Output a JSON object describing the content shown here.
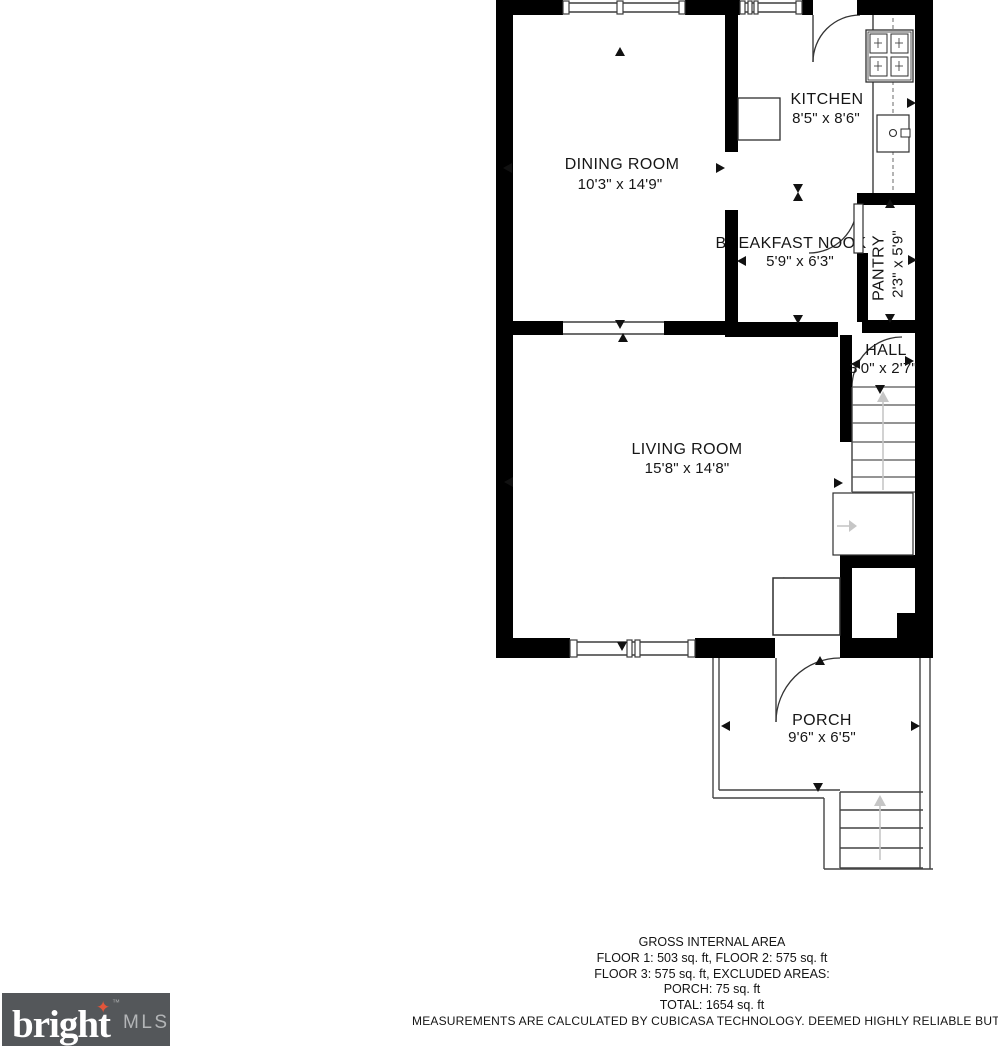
{
  "page": {
    "background": "#ffffff"
  },
  "floorplan": {
    "rooms": [
      {
        "name": "DINING ROOM",
        "dims": "10'3\" x 14'9\""
      },
      {
        "name": "KITCHEN",
        "dims": "8'5\" x 8'6\""
      },
      {
        "name": "BREAKFAST NOOK",
        "dims": "5'9\" x 6'3\""
      },
      {
        "name": "PANTRY",
        "dims": "2'3\" x 5'9\""
      },
      {
        "name": "HALL",
        "dims": "3'0\" x 2'7\""
      },
      {
        "name": "LIVING ROOM",
        "dims": "15'8\" x 14'8\""
      },
      {
        "name": "PORCH",
        "dims": "9'6\" x 6'5\""
      }
    ],
    "wall_color": "#000000",
    "line_color": "#3d3d3d",
    "arrow_color": "#c6c6c6"
  },
  "footer": {
    "title": "GROSS INTERNAL AREA",
    "line1": "FLOOR 1: 503 sq. ft, FLOOR 2: 575 sq. ft",
    "line2": "FLOOR 3: 575 sq. ft, EXCLUDED AREAS:",
    "line3": "PORCH: 75 sq. ft",
    "line4": "TOTAL: 1654 sq. ft",
    "disclaimer": "MEASUREMENTS ARE CALCULATED BY CUBICASA TECHNOLOGY. DEEMED HIGHLY RELIABLE BUT NOT GUARANTEED"
  },
  "logo": {
    "brand": "bright",
    "trademark": "™",
    "suffix": "MLS",
    "star_icon": "✦",
    "background": "#54575a",
    "brand_color": "#ffffff",
    "suffix_color": "#b3b5b7",
    "star_color": "#e2553a"
  }
}
